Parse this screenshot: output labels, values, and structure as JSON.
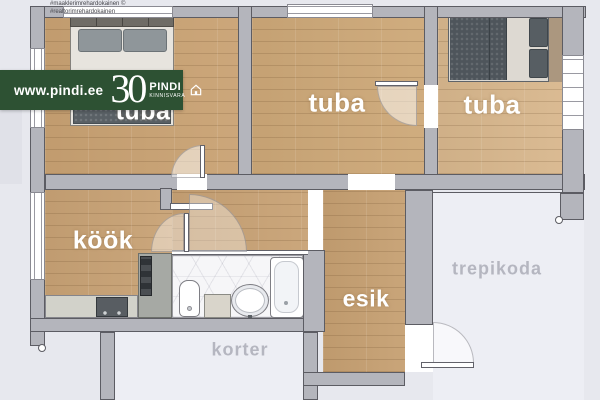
{
  "watermark": {
    "line1": "#maaklerimrehardokainen ©",
    "line2": "#realtorimrehardokainen"
  },
  "banner": {
    "url": "www.pindi.ee",
    "years": "30",
    "brand": "PINDI",
    "brand_sub": "KINNISVARA",
    "icon": "house-icon",
    "bg_color": "#2d5133"
  },
  "labels": {
    "room1": "tuba",
    "room2": "tuba",
    "room3": "tuba",
    "kitchen": "köök",
    "hallway": "esik",
    "stairwell": "trepikoda",
    "neighbor": "korter"
  },
  "colors": {
    "banner_green": "#2d5133",
    "wall_gray": "#b4b5bc",
    "wall_outline": "#5c5c63",
    "wood_floor": "#cba577",
    "wood_floor_light": "#d8b78d",
    "background": "#e7e8ee",
    "exterior_area": "#edeef4",
    "room_label": "#ffffff",
    "exterior_label": "#b5b6c0"
  }
}
